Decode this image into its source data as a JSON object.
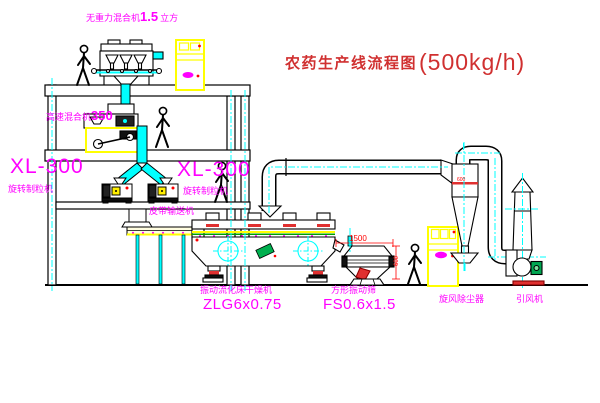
{
  "title": {
    "text": "农药生产线流程图",
    "capacity": "(500kg/h)"
  },
  "equipment_labels": {
    "gravity_mixer": {
      "name": "无重力混合机",
      "size": "1.5",
      "unit": "立方"
    },
    "high_speed_mixer": {
      "name": "高速混合机",
      "size": "350"
    },
    "granulator_left": {
      "model": "XL-300",
      "name": "旋转制粒机"
    },
    "granulator_right": {
      "model": "XL-300",
      "name": "旋转制粒机"
    },
    "belt_conveyor": {
      "name": "皮带输送机"
    },
    "fluid_bed_dryer": {
      "name": "振动流化床干燥机",
      "model": "ZLG6x0.75"
    },
    "vibrating_screen": {
      "name": "方形振动筛",
      "model": "FS0.6x1.5"
    },
    "cyclone": {
      "name": "旋风除尘器"
    },
    "induced_draft_fan": {
      "name": "引风机"
    }
  },
  "dimensions": {
    "screen_length": "1500",
    "screen_width": "600",
    "cyclone_size": "600"
  },
  "colors": {
    "label_magenta": "#FF00FF",
    "title_red": "#D03030",
    "dimension_red": "#FF0000",
    "centerline_cyan": "#00FFFF",
    "cabinet_yellow": "#FFFF00",
    "line_black": "#000000",
    "motor_green": "#00A651"
  }
}
